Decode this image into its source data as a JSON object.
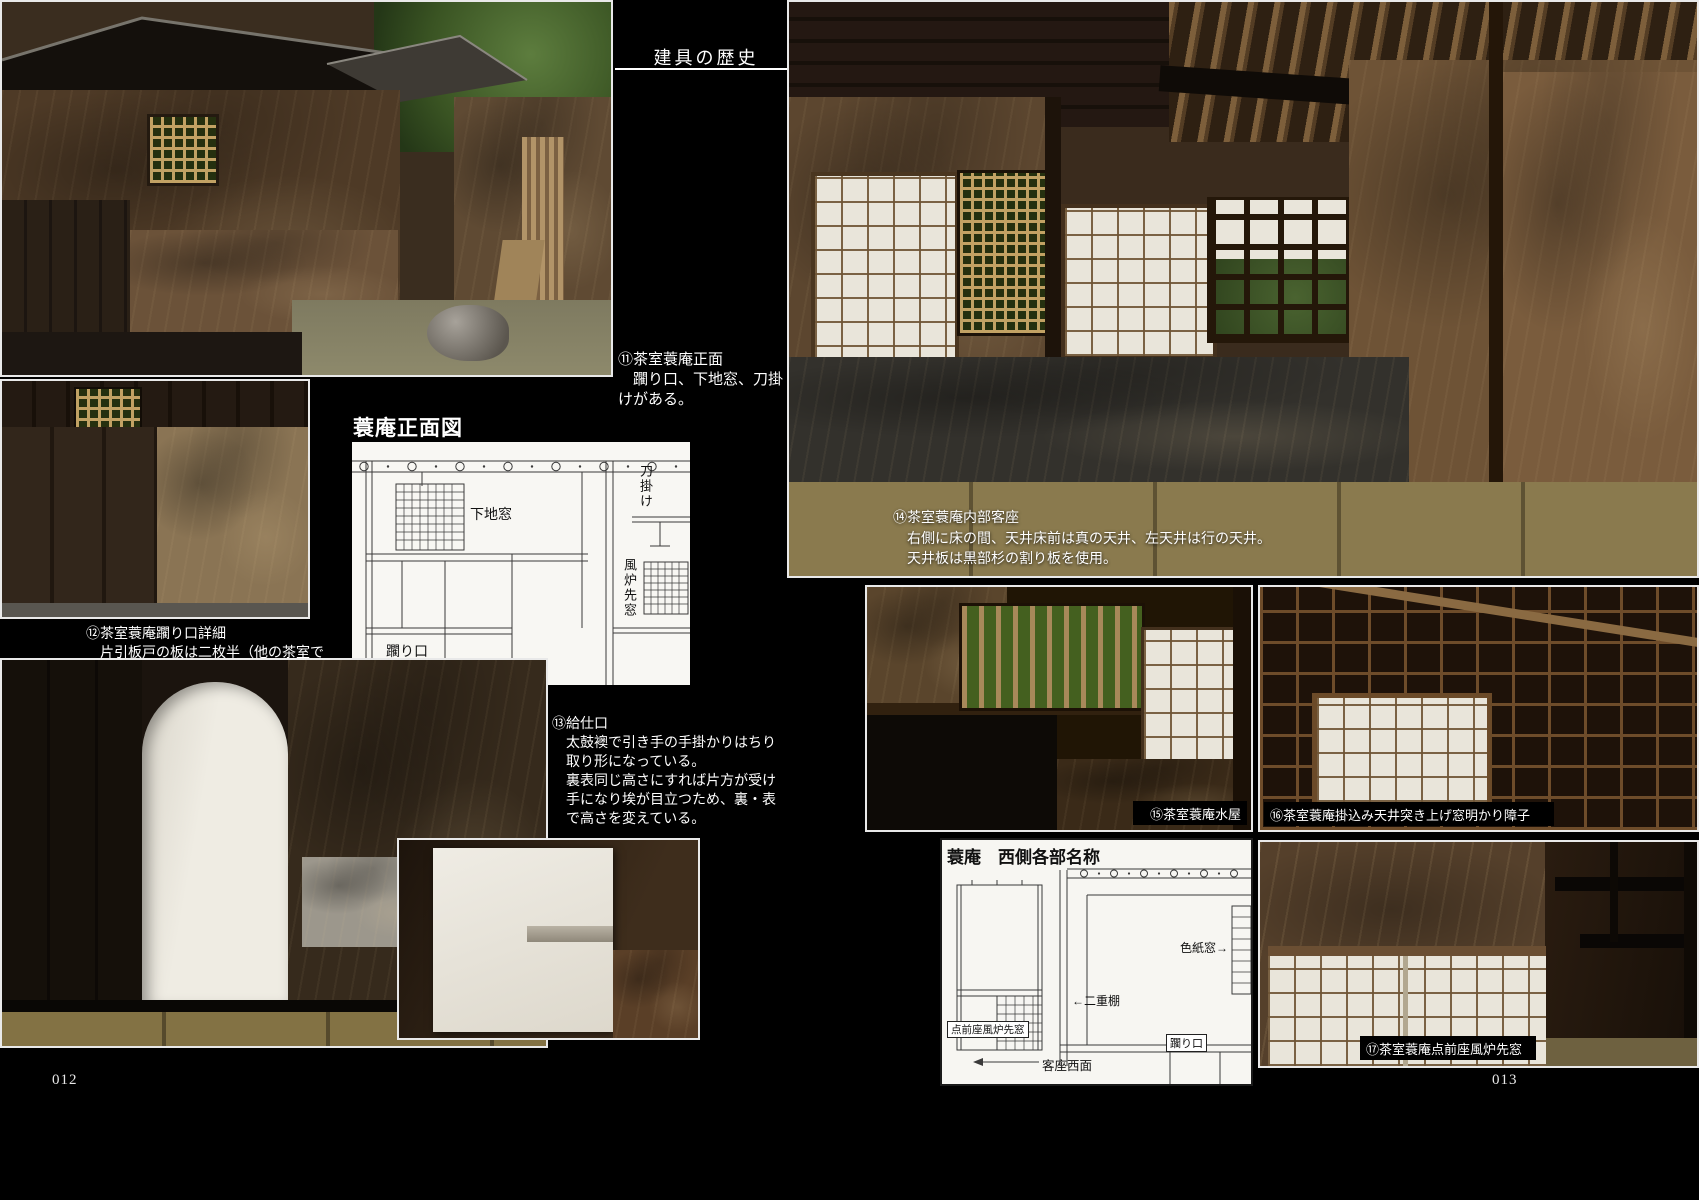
{
  "header": {
    "title": "建具の歴史"
  },
  "page_numbers": {
    "left": "012",
    "right": "013"
  },
  "captions": {
    "c11": {
      "lines": [
        "⑪茶室蓑庵正面",
        "　躙り口、下地窓、刀掛",
        "けがある。"
      ]
    },
    "c12": {
      "lines": [
        "⑫茶室蓑庵躙り口詳細",
        "　片引板戸の板は二枚半（他の茶室で",
        "　は三つ割りのものもあるが、二枚半",
        "　の方が多い）。"
      ]
    },
    "c13": {
      "lines": [
        "⑬給仕口",
        "　太鼓襖で引き手の手掛かりはちり",
        "　取り形になっている。",
        "　裏表同じ高さにすれば片方が受け",
        "　手になり埃が目立つため、裏・表",
        "　で高さを変えている。"
      ]
    },
    "c14": {
      "lines": [
        "⑭茶室蓑庵内部客座",
        "　右側に床の間、天井床前は真の天井、左天井は行の天井。",
        "　天井板は黒部杉の割り板を使用。"
      ]
    }
  },
  "photo_labels": {
    "p15": "⑮茶室蓑庵水屋",
    "p16": "⑯茶室蓑庵掛込み天井突き上げ窓明かり障子",
    "p17": "⑰茶室蓑庵点前座風炉先窓"
  },
  "diagram_front": {
    "title": "蓑庵正面図",
    "labels": {
      "shitajimado": "下地窓",
      "katanakake": "刀掛け",
      "furosakimado": "風炉先窓",
      "nijiriguchi": "躙り口"
    }
  },
  "diagram_west": {
    "title": "蓑庵　西側各部名称",
    "labels": {
      "shikishimado": "色紙窓→",
      "nijudana": "←二重棚",
      "temaeza_furosakimado": "点前座風炉先窓",
      "kyakuza_seimen": "客座西面",
      "nijiriguchi": "躙り口"
    }
  },
  "colors": {
    "page_background": "#000000",
    "caption_text": "#ffffff",
    "diagram_paper": "#f7f6f2",
    "diagram_line": "#3a3a3a"
  }
}
